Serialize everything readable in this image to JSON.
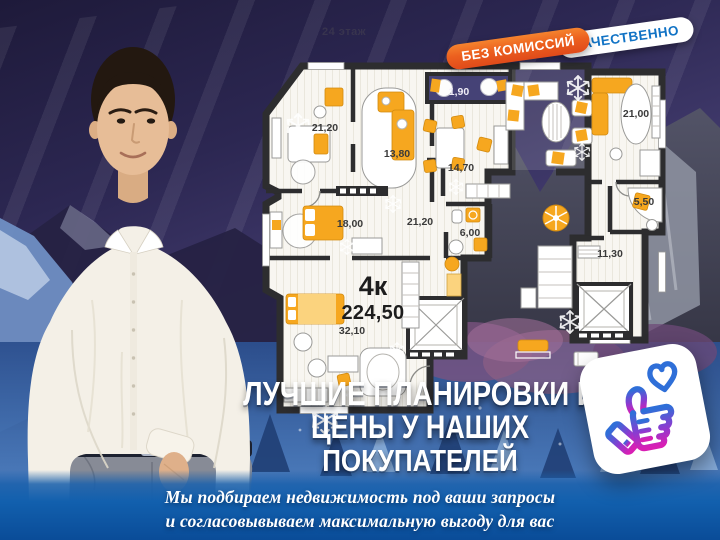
{
  "floor_note": "24 этаж",
  "badges": {
    "no_commission": "БЕЗ КОМИССИЙ",
    "quality": "КАЧЕСТВЕННО"
  },
  "plan": {
    "type_label": "4к",
    "total_area": "224,50",
    "rooms": [
      {
        "area": "21,20",
        "x": 325,
        "y": 128
      },
      {
        "area": "13,80",
        "x": 397,
        "y": 154
      },
      {
        "area": "14,70",
        "x": 461,
        "y": 168
      },
      {
        "area": "1,90",
        "x": 459,
        "y": 92,
        "style": "light"
      },
      {
        "area": "18,00",
        "x": 350,
        "y": 224
      },
      {
        "area": "21,20",
        "x": 420,
        "y": 222
      },
      {
        "area": "6,00",
        "x": 470,
        "y": 233
      },
      {
        "area": "32,10",
        "x": 352,
        "y": 331
      },
      {
        "area": "21,00",
        "x": 636,
        "y": 114
      },
      {
        "area": "5,50",
        "x": 644,
        "y": 202
      },
      {
        "area": "11,30",
        "x": 610,
        "y": 254
      }
    ]
  },
  "title": {
    "lines": [
      "ЛУЧШИЕ ПЛАНИРОВКИ И",
      "ЦЕНЫ У НАШИХ",
      "ПОКУПАТЕЛЕЙ"
    ]
  },
  "footer": {
    "lines": [
      "Мы подбираем недвижимость под ваши запросы",
      "и согласовывываем максимальную выгоду для вас"
    ]
  },
  "icons": {
    "like": "thumbs-up-icon",
    "heart": "heart-icon",
    "snowflake": "snowflake-icon"
  },
  "colors": {
    "badge_orange": "#ec601f",
    "badge_blue_text": "#1173c5",
    "plan_wall": "#2d2d2f",
    "furniture_orange": "#f6a71f",
    "loggia_blue": "#454276",
    "footer_top": "#1c61ac",
    "footer_bottom": "#0a4c98",
    "like_gradient_top": "#2f6fd8",
    "like_gradient_bottom": "#d81fb4"
  }
}
